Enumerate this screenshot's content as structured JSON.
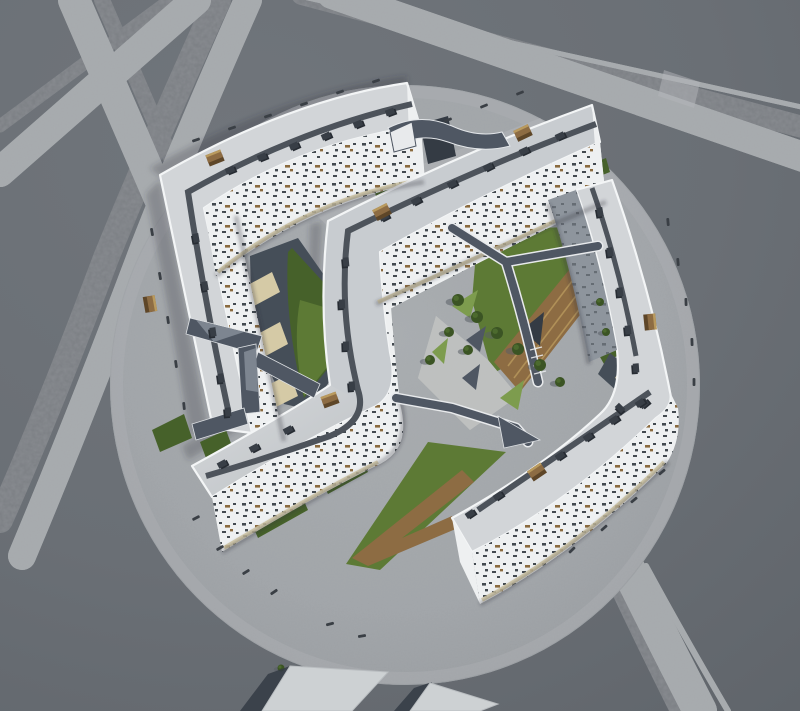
{
  "meta": {
    "type": "architectural-aerial-render",
    "subject": "circular housing complex with five bent white slab buildings, green roof courtyards, slate bridges and wooden decks",
    "view": "high oblique aerial",
    "canvas": {
      "width": 800,
      "height": 711
    }
  },
  "palette": {
    "ground": "#6a6f75",
    "groundDark": "#61666c",
    "roadLight": "#a6aaad",
    "roadRough": "#7a7e83",
    "plaza": "#9da1a5",
    "plazaCore": "#a6aaad",
    "plazaLight": "#b3b6b9",
    "pave": "#bfc1c0",
    "roof": "#d2d5d8",
    "roofD": "#c8ccd0",
    "parapet": "#f3f5f6",
    "facade": "#eef0f1",
    "facadeShade": "#8e959d",
    "window": "#434a50",
    "windowWood": "#8a6a3e",
    "windowShade": "#666d74",
    "walkway": "#4d535b",
    "vent": "#383e46",
    "ventShadow": "#272c33",
    "wood": "#8d6c43",
    "woodLight": "#b99a5e",
    "woodDark": "#5e4628",
    "slate": "#4f5763",
    "slateLight": "#7d8590",
    "slateDark": "#343b44",
    "grass": "#5d7a35",
    "grassDark": "#46612a",
    "grassBright": "#7d9c4e",
    "water": "#454e58",
    "terrace": "#d5caa6",
    "tree": "#3b5424",
    "treeShadow": "#595f66",
    "shadow": "#2e333a",
    "bench": "#3a3f45",
    "slabTop": "#cdd1d3",
    "slabSide": "#aeb3b6",
    "white": "#e8eaec"
  },
  "scene": {
    "paths": {
      "medQ": "M170,0 L0,126",
      "medR": "M218,0 Q150,150 106,258 Q50,408 0,520",
      "medP": "M102,0 L216,262",
      "medTR": "M302,-6 L806,128",
      "medBR": "M596,540 Q630,615 678,711",
      "roadQ": "M196,0 L0,172",
      "roadR": "M248,0 Q186,140 144,248 Q84,408 22,556",
      "roadP": "M74,0 L196,282",
      "roadTR": "M332,-6 L806,158",
      "roadBR": "M612,536 Q648,610 700,711",
      "thinTR": "M290,-6 L806,108",
      "sideBR": "M646,566 Q684,636 728,711",
      "crosswalk": "M664,70 L700,82 L694,108 L658,96 Z",
      "shA1": "M150,168 Q285,92 407,76 L407,86 Q290,100 162,178 Z",
      "shA2": "M160,180 L208,430 L190,436 Q168,300 146,194 Z",
      "shBD": "M322,222 L314,384 L188,460 L182,446 L306,374 L310,224 Z",
      "cy1Slate": "M250,256 L298,238 L336,292 L344,360 L310,410 L284,404 L252,330 Z",
      "cy1Grass": "M292,248 L336,296 L338,356 L304,398 Q284,320 288,252 Z",
      "cy1GrassLit": "M300,300 L334,310 L336,356 L304,396 Q292,344 300,300 Z",
      "cy2Grass": "M478,230 L600,226 L616,262 L532,352 L492,374 L472,300 Z",
      "cy2Deck": "M600,232 L618,266 L520,392 L494,362 Z",
      "cy2Hole": "M522,330 L544,312 L540,346 Z",
      "cy2Pave": "M436,316 L488,360 L518,396 L470,430 L418,378 Z",
      "cyNEPave": "M310,208 L540,118 L582,162 L352,252 Z",
      "tanA1": "M234,214 L304,188 L310,206 L240,234 Z",
      "cy3Grass": "M346,564 L428,442 L506,452 L380,570 Z",
      "cy3Wood": "M352,558 L462,470 L474,482 L402,538 L452,516 L458,528 L368,566 Z",
      "slateE": "M610,353 L655,390 L640,412 L598,374 Z",
      "deckE": "M622,366 L654,388 L646,400 L615,378 Z",
      "beigeE": "M624,462 L658,444 L664,462 L630,480 Z",
      "aRoof": "M407,83 Q290,100 160,175 Q186,300 213,428 L252,433 Q228,320 204,208 Q300,142 420,126 Z",
      "aF1": "M204,208 Q300,142 418,126 L424,182 Q310,202 216,276 Z",
      "aF2": "M204,208 Q228,320 252,433 L284,441 Q260,330 236,216 Z",
      "aCap": "M407,83 L421,126 L425,182 L409,136 Z",
      "aWalk": "M412,104 Q298,130 188,192 Q206,310 232,428",
      "bdRoof": "M592,105 Q462,152 328,221 Q318,305 330,385 Q290,412 192,466 L212,497 Q310,436 372,408 Q400,396 390,352 Q382,298 380,252 Q478,196 600,142 Z",
      "bdF1": "M600,142 Q478,196 380,252 L388,310 Q486,258 606,200 Z",
      "bdF2": "M380,252 Q382,298 390,352 Q400,396 372,408 Q310,436 212,497 L222,552 Q318,494 380,464 Q412,448 400,404 Q390,308 388,258 Z",
      "bdCap": "M592,105 L600,142 L606,200 L596,160 Z",
      "bdWalk": "M596,124 Q472,170 348,231 Q338,310 358,390 Q368,420 330,436 Q268,458 206,476",
      "dRoofLight": "M330,385 Q290,412 192,466 L212,497 Q310,436 372,408 Z",
      "ceRoof": "M612,180 Q650,288 670,392 Q674,406 656,418 Q565,506 472,552 L452,518 Q540,470 600,414 Q622,394 617,350 Q600,255 576,190 Z",
      "ceFW": "M576,190 Q600,258 617,350 L589,362 Q570,262 548,200 Z",
      "ceFSE": "M670,392 Q674,406 656,418 Q565,506 472,552 L480,604 Q578,552 666,464 Q682,440 678,408 Z",
      "ceCapS": "M472,552 L480,604 L460,562 L452,518 Z",
      "cWalk": "M592,188 Q620,268 636,356",
      "eWalk": "M478,510 L650,392",
      "stA1": "M218,272 Q310,198 422,180",
      "stBD": "M224,548 Q318,492 378,462",
      "stB1": "M378,302 Q486,254 604,198",
      "stCE": "M482,600 Q578,548 664,462",
      "ctA1": "M216,276 Q310,200 424,182",
      "ctA2": "M236,216 Q260,328 284,441",
      "ctB1": "M376,304 Q482,254 606,202",
      "ctBD": "M222,552 Q316,496 378,464 Q412,446 400,400",
      "ctCE": "M480,604 Q575,552 668,462",
      "ctCW": "M548,204 Q570,265 589,364",
      "br1Body": "M388,128 Q420,112 452,126 Q478,138 502,132 L510,146 Q480,154 448,142 Q420,132 398,146 Z",
      "br1Chasm": "M420,124 L448,116 L456,156 L428,164 Z",
      "br1Truss": "M390,132 L412,122 L416,146 L394,152 Z",
      "br2s1": "M190,318 L262,336 L256,354 L186,334 Z",
      "br2s2": "M238,348 L256,344 L260,412 L242,414 Z",
      "br2s3": "M244,408 L248,424 L196,440 L192,424 Z",
      "br2s4": "M258,352 L320,384 L314,398 L254,366 Z",
      "br2f1": "M196,320 L244,332 L214,342 Z",
      "br2f2": "M244,352 L256,348 L258,392 L246,390 Z",
      "br3a": "M452,228 L506,262",
      "br3b": "M506,262 L598,246",
      "br3c": "M506,262 Q524,320 538,382",
      "br4a": "M396,398 L452,408 L516,428 L528,442",
      "br4Tri": "M498,416 L540,440 L504,448 Z",
      "slab1": "M262,711 L290,666 L388,672 L352,711 Z",
      "slab1Shadow": "M240,711 L262,711 L290,666 L268,674 Z",
      "slab2": "M410,711 L430,683 L498,704 L480,711 Z",
      "slab2Shadow": "M394,711 L412,711 L432,682 L414,688 Z"
    },
    "greens": [
      "M372,184 L392,176 L396,188 L376,196 Z",
      "M408,196 L444,180 L450,194 L414,210 Z",
      "M564,196 L596,184 L602,200 L570,212 Z",
      "M586,166 L606,158 L610,172 L590,180 Z",
      "M152,430 L184,414 L192,438 L160,452 Z",
      "M200,442 L226,430 L232,446 L206,458 Z",
      "M250,520 L300,492 L308,510 L258,538 Z",
      "M320,478 L360,456 L368,472 L328,494 Z",
      "M596,350 L612,340 L620,354 L604,364 Z",
      "M606,470 L622,462 L628,476 L612,484 Z"
    ],
    "brightWedges": [
      "M452,306 L478,290 L470,318 Z",
      "M500,398 L524,380 L518,410 Z",
      "M432,352 L448,338 L444,364 Z"
    ],
    "slateWedges": [
      "M466,340 L486,326 L480,352 Z",
      "M462,378 L480,364 L476,390 Z"
    ],
    "terraces": [
      "M246,286 L272,272 L280,292 L254,306 Z",
      "M254,336 L280,322 L288,344 L262,358 Z",
      "M262,388 L290,374 L298,396 L270,410 Z"
    ],
    "deckStripes": [
      "M603,240 L508,366",
      "M609,252 L514,378",
      "M615,262 L520,388"
    ],
    "stairsE": [
      "M626,372 L620,380",
      "M632,377 L626,385",
      "M638,382 L632,390",
      "M644,387 L638,395"
    ],
    "stairsY": [
      "M530,350 L542,347",
      "M531,358 L543,355",
      "M533,366 L545,363",
      "M534,374 L546,371"
    ],
    "vents": [
      [
        230,
        170,
        -22
      ],
      [
        262,
        157,
        -22
      ],
      [
        294,
        146,
        -24
      ],
      [
        326,
        136,
        -24
      ],
      [
        358,
        124,
        -22
      ],
      [
        390,
        112,
        -20
      ],
      [
        196,
        238,
        80
      ],
      [
        205,
        286,
        80
      ],
      [
        213,
        332,
        82
      ],
      [
        221,
        378,
        82
      ],
      [
        228,
        412,
        84
      ],
      [
        560,
        136,
        -25
      ],
      [
        524,
        151,
        -25
      ],
      [
        488,
        167,
        -27
      ],
      [
        452,
        184,
        -27
      ],
      [
        416,
        201,
        -28
      ],
      [
        384,
        217,
        -28
      ],
      [
        346,
        262,
        85
      ],
      [
        342,
        304,
        87
      ],
      [
        346,
        346,
        88
      ],
      [
        352,
        386,
        85
      ],
      [
        288,
        430,
        -28
      ],
      [
        254,
        448,
        -28
      ],
      [
        222,
        464,
        -28
      ],
      [
        600,
        212,
        80
      ],
      [
        610,
        252,
        82
      ],
      [
        620,
        292,
        84
      ],
      [
        628,
        330,
        84
      ],
      [
        636,
        368,
        86
      ],
      [
        620,
        408,
        45
      ],
      [
        644,
        404,
        -40
      ],
      [
        470,
        514,
        -34
      ],
      [
        498,
        496,
        -34
      ],
      [
        560,
        456,
        -34
      ],
      [
        588,
        437,
        -34
      ],
      [
        614,
        420,
        -34
      ],
      [
        640,
        403,
        -34
      ]
    ],
    "boxes": [
      [
        215,
        158,
        -22
      ],
      [
        150,
        304,
        80
      ],
      [
        523,
        133,
        -25
      ],
      [
        382,
        212,
        -27
      ],
      [
        330,
        400,
        -20
      ],
      [
        537,
        472,
        -34
      ],
      [
        650,
        322,
        84
      ]
    ],
    "benches": [
      [
        196,
        140,
        -19
      ],
      [
        232,
        128,
        -19
      ],
      [
        268,
        116,
        -19
      ],
      [
        304,
        104,
        -19
      ],
      [
        340,
        92,
        -19
      ],
      [
        376,
        81,
        -19
      ],
      [
        448,
        120,
        -22
      ],
      [
        484,
        106,
        -22
      ],
      [
        520,
        93,
        -22
      ],
      [
        152,
        232,
        80
      ],
      [
        160,
        276,
        80
      ],
      [
        168,
        320,
        82
      ],
      [
        176,
        364,
        82
      ],
      [
        184,
        406,
        84
      ],
      [
        668,
        222,
        85
      ],
      [
        678,
        262,
        85
      ],
      [
        686,
        302,
        88
      ],
      [
        692,
        342,
        88
      ],
      [
        694,
        382,
        90
      ],
      [
        662,
        472,
        -40
      ],
      [
        634,
        500,
        -40
      ],
      [
        604,
        528,
        -42
      ],
      [
        572,
        550,
        -44
      ],
      [
        196,
        518,
        -28
      ],
      [
        220,
        548,
        -30
      ],
      [
        246,
        572,
        -32
      ],
      [
        274,
        592,
        -34
      ],
      [
        330,
        624,
        -14
      ],
      [
        362,
        636,
        -10
      ]
    ],
    "trees": [
      [
        458,
        300,
        6
      ],
      [
        477,
        317,
        6
      ],
      [
        497,
        333,
        6
      ],
      [
        518,
        349,
        6
      ],
      [
        540,
        365,
        6
      ],
      [
        449,
        332,
        5
      ],
      [
        468,
        350,
        5
      ],
      [
        430,
        360,
        5
      ],
      [
        560,
        382,
        5
      ],
      [
        600,
        302,
        4
      ],
      [
        606,
        332,
        4
      ],
      [
        281,
        668,
        3.5
      ],
      [
        299,
        678,
        3.5
      ],
      [
        316,
        686,
        3
      ]
    ],
    "plazaEllipse": {
      "cx": 405,
      "cy": 385,
      "rx": 295,
      "ry": 300
    }
  }
}
